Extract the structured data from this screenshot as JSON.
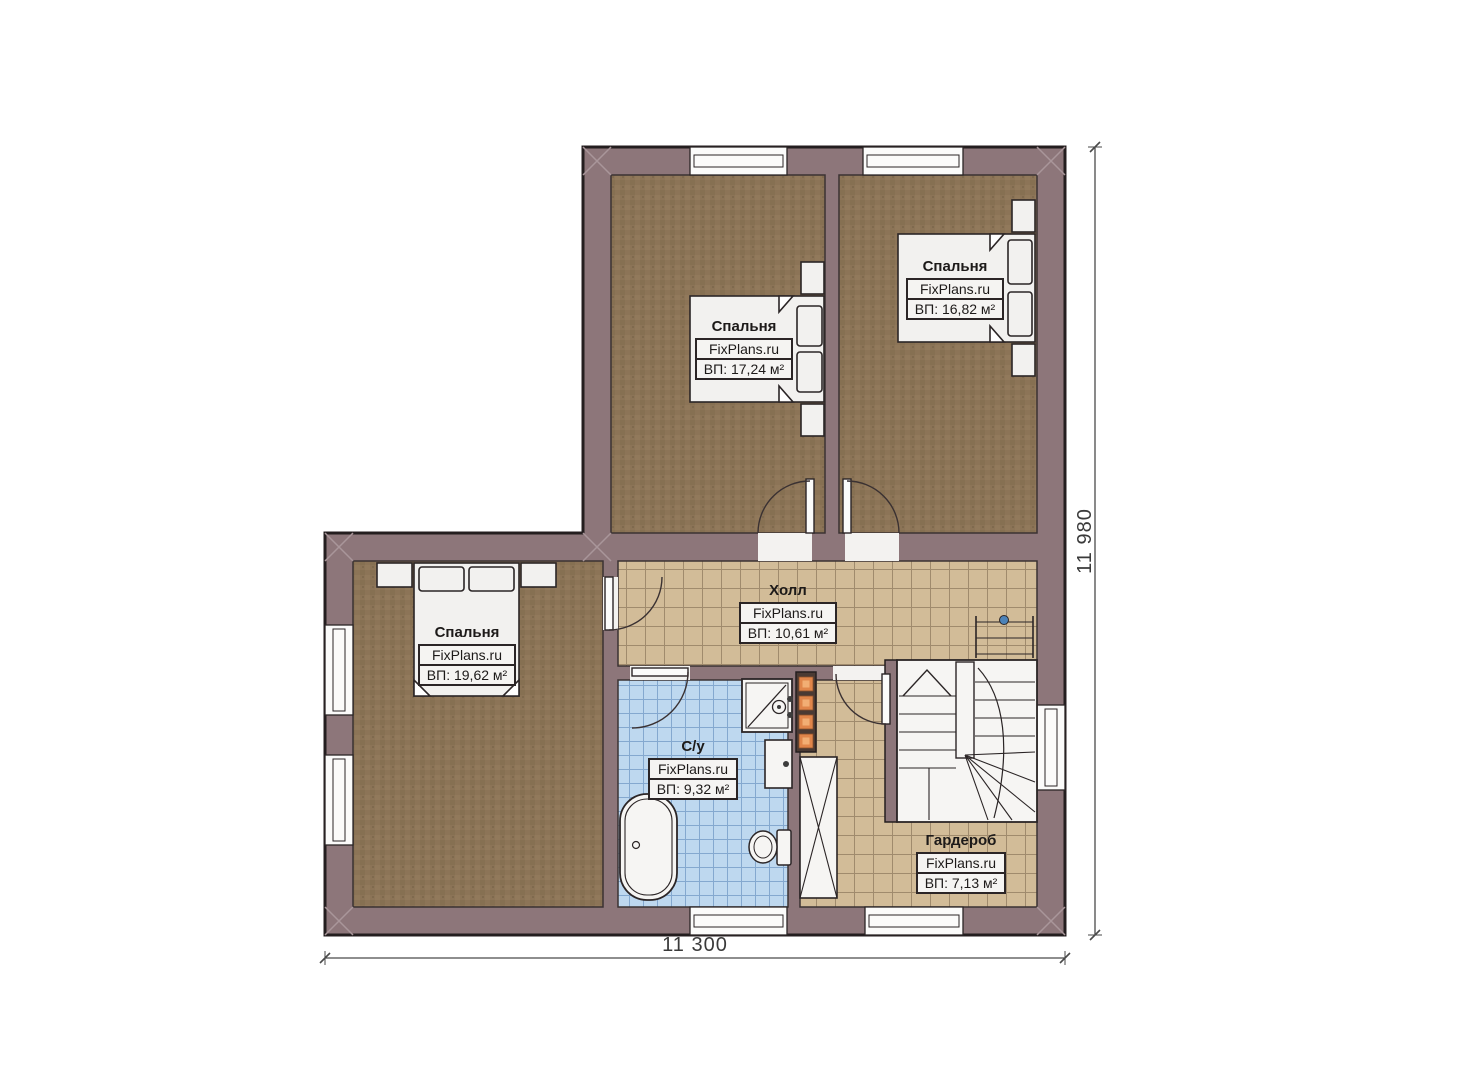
{
  "rooms": [
    {
      "id": "bedroom-top-left",
      "name": "Спальня",
      "watermark": "FixPlans.ru",
      "area": "ВП: 17,24 м²"
    },
    {
      "id": "bedroom-top-right",
      "name": "Спальня",
      "watermark": "FixPlans.ru",
      "area": "ВП: 16,82 м²"
    },
    {
      "id": "hall",
      "name": "Холл",
      "watermark": "FixPlans.ru",
      "area": "ВП: 10,61 м²"
    },
    {
      "id": "bedroom-bottom-left",
      "name": "Спальня",
      "watermark": "FixPlans.ru",
      "area": "ВП: 19,62 м²"
    },
    {
      "id": "bathroom",
      "name": "С/у",
      "watermark": "FixPlans.ru",
      "area": "ВП: 9,32 м²"
    },
    {
      "id": "wardrobe",
      "name": "Гардероб",
      "watermark": "FixPlans.ru",
      "area": "ВП: 7,13 м²"
    }
  ],
  "dimensions": {
    "width_label": "11 300",
    "height_label": "11 980"
  },
  "colors": {
    "wall": "#8d767a",
    "outline": "#241e1f",
    "bedroom_floor": "#8c7457",
    "tile_tan": "#d2bc98",
    "tile_blue": "#bed8ef",
    "fixture": "#f5f4f2",
    "shaft_orange": "#e0854a",
    "stair_dot_blue": "#4d83b8"
  }
}
